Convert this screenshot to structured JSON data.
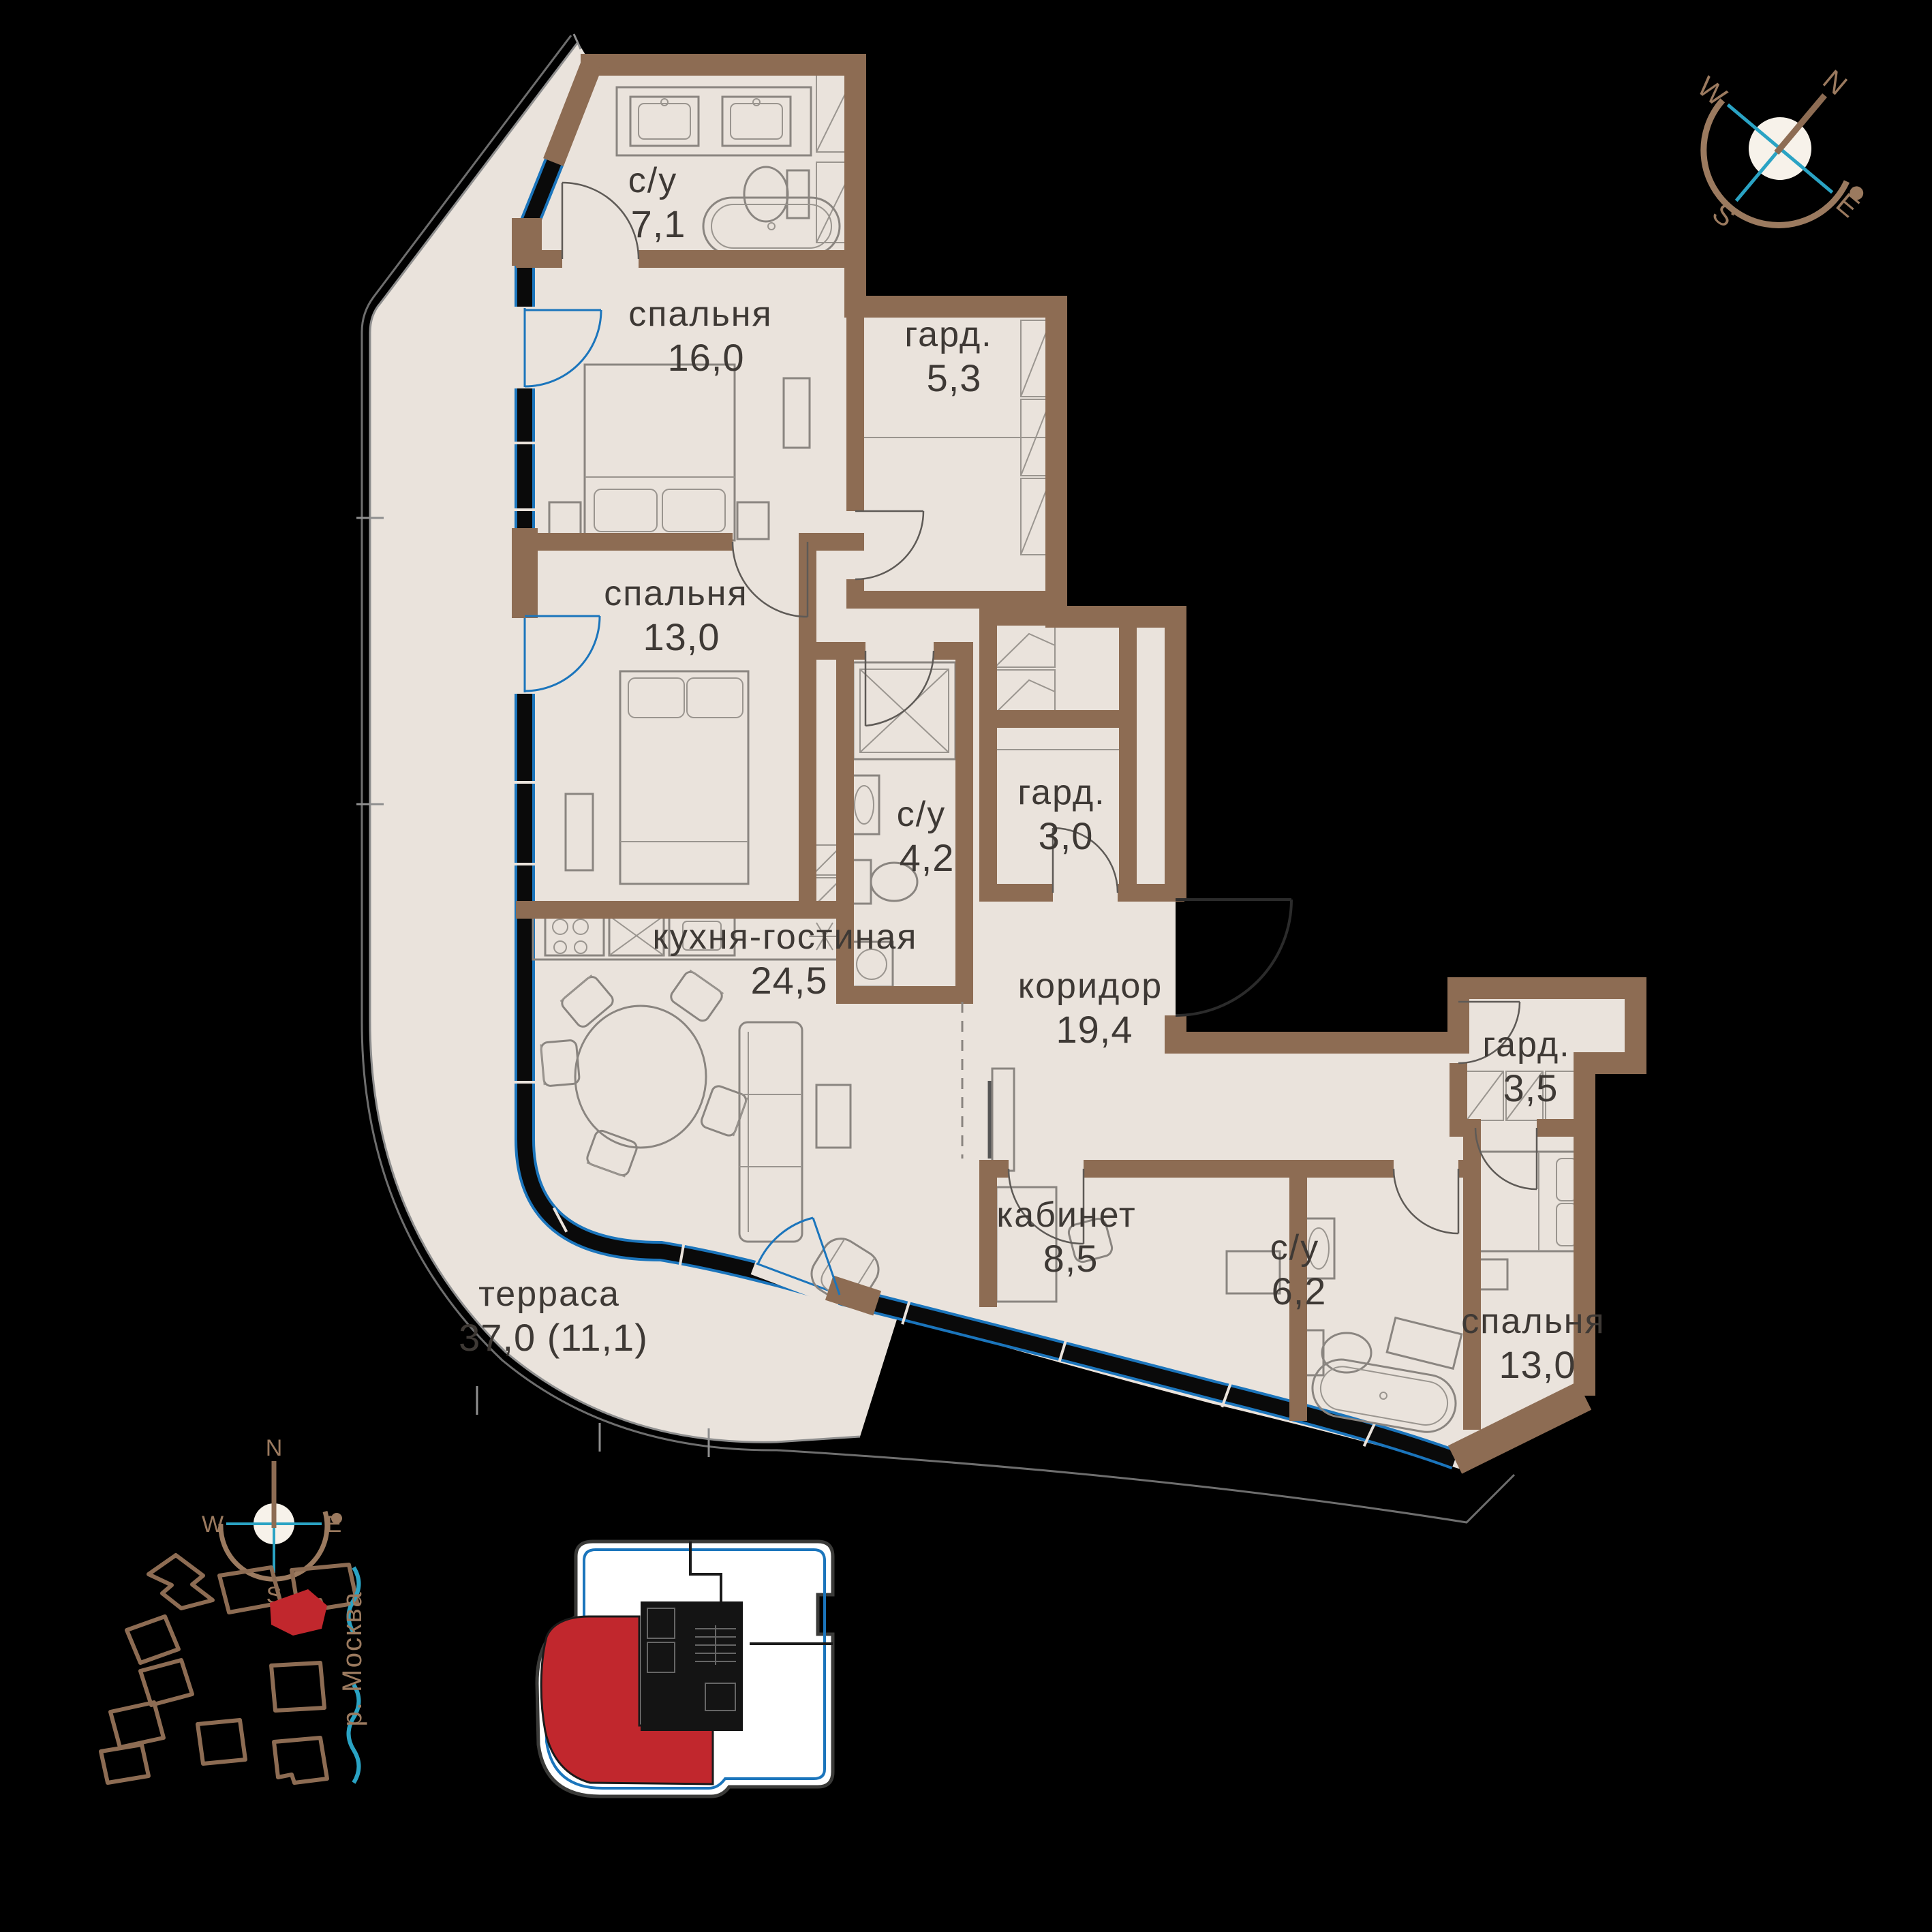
{
  "title": "apartment-floor-plan",
  "colors": {
    "background": "#000000",
    "walls": "#8D6C53",
    "floor": "#EAE3DC",
    "glazing_blue": "#1B75BC",
    "accent_teal": "#2AA3C4",
    "highlight_red": "#C1272D",
    "text": "#3E3935",
    "compass_brown": "#9B7A5F"
  },
  "rooms": [
    {
      "id": "bathroom-1",
      "name": "с/у",
      "area": "7,1"
    },
    {
      "id": "bedroom-1",
      "name": "спальня",
      "area": "16,0"
    },
    {
      "id": "wardrobe-1",
      "name": "гард.",
      "area": "5,3"
    },
    {
      "id": "bedroom-2",
      "name": "спальня",
      "area": "13,0"
    },
    {
      "id": "bathroom-2",
      "name": "с/у",
      "area": "4,2"
    },
    {
      "id": "wardrobe-2",
      "name": "гард.",
      "area": "3,0"
    },
    {
      "id": "kitchen-living",
      "name": "кухня-гостиная",
      "area": "24,5"
    },
    {
      "id": "corridor",
      "name": "коридор",
      "area": "19,4"
    },
    {
      "id": "wardrobe-3",
      "name": "гард.",
      "area": "3,5"
    },
    {
      "id": "study",
      "name": "кабинет",
      "area": "8,5"
    },
    {
      "id": "bathroom-3",
      "name": "с/у",
      "area": "6,2"
    },
    {
      "id": "bedroom-3",
      "name": "спальня",
      "area": "13,0"
    },
    {
      "id": "terrace",
      "name": "терраса",
      "area": "37,0 (11,1)"
    }
  ],
  "compass": {
    "n": "N",
    "e": "E",
    "s": "S",
    "w": "W"
  },
  "site_plan": {
    "river_label": "р. Москва",
    "compass": {
      "n": "N",
      "e": "E",
      "s": "S",
      "w": "W"
    }
  }
}
